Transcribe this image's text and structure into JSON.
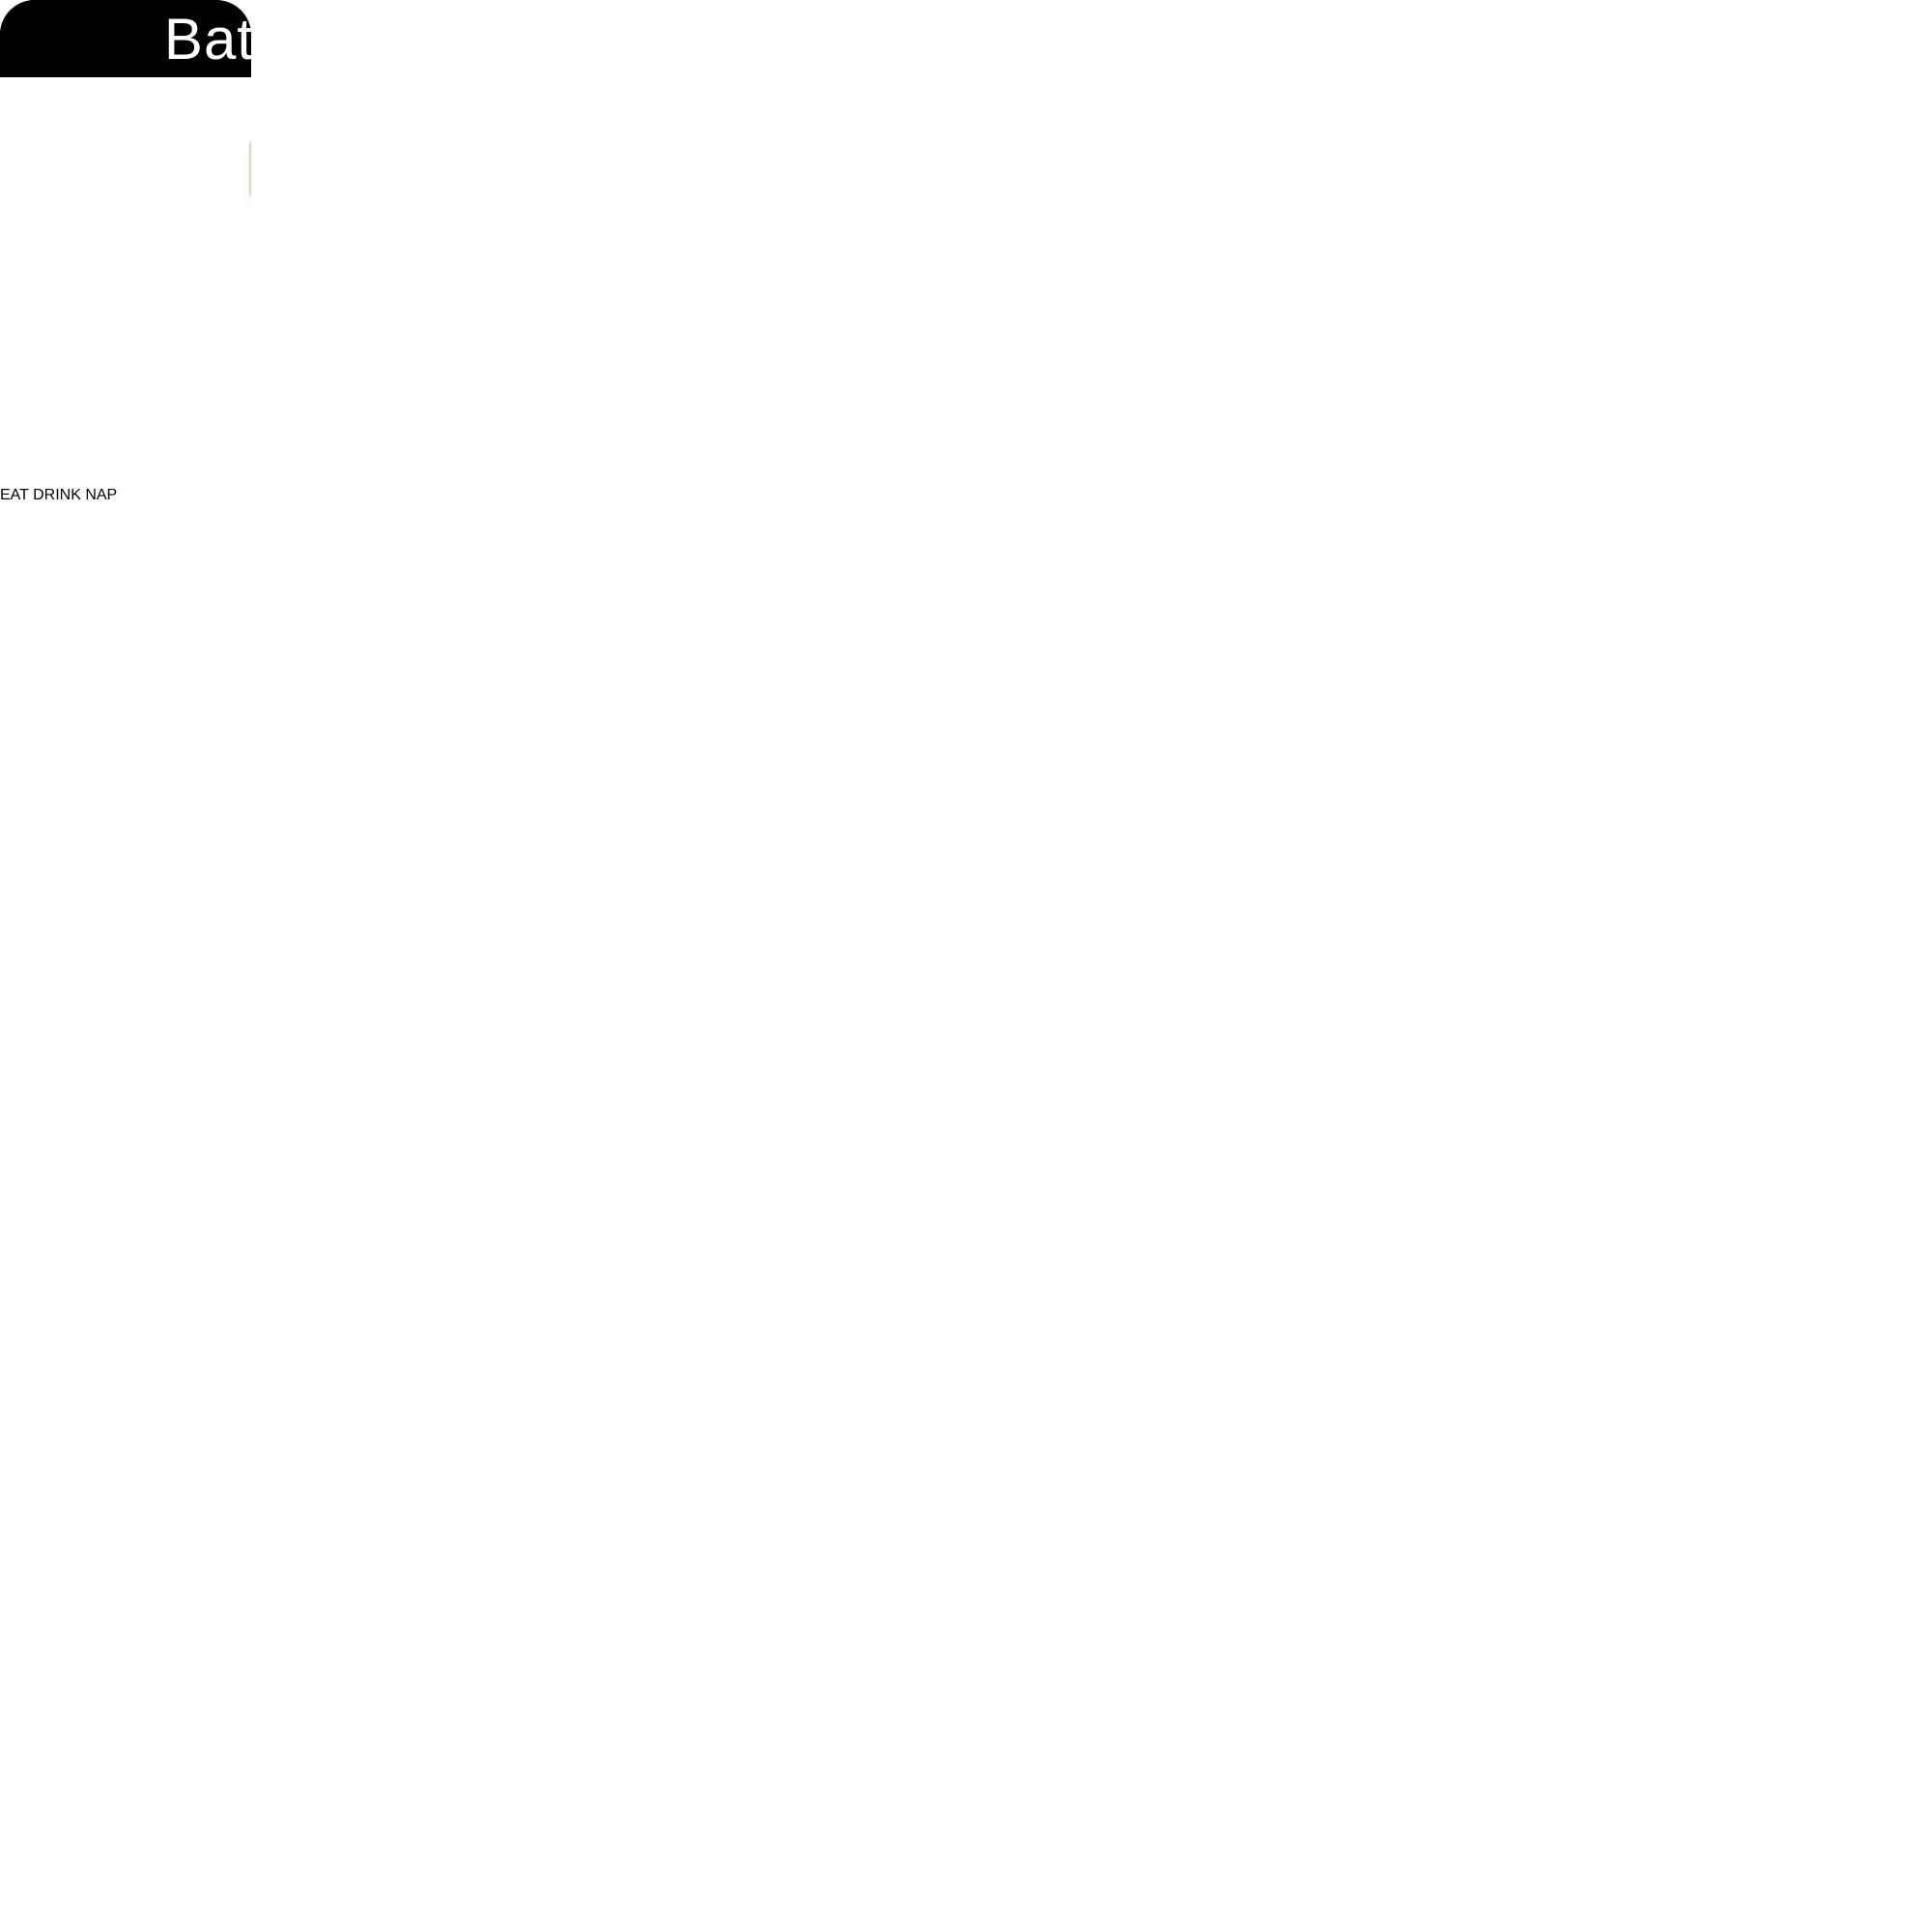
{
  "collage": {
    "description": "three-scene product collage of a 6-light black vanity light fixture with white cylindrical glass shades",
    "sections": [
      {
        "id": "living-room",
        "label": "Living Room"
      },
      {
        "id": "dining-room",
        "label": "Dining Room"
      },
      {
        "id": "bathroom",
        "label": "Bathroom"
      }
    ]
  },
  "fixture": {
    "lights_count": 6,
    "metal_color": "#1b1917",
    "shade_color": "#f7f1e2"
  },
  "inset_decor": {
    "shelf_sign_line1": "EAT",
    "shelf_sign_line2": "DRINK",
    "shelf_sign_line3": "NAP"
  },
  "colors": {
    "label_bg": "#000000",
    "label_text": "#ffffff",
    "living_wall_tan": "#d5c2a4",
    "dining_wall_cream": "#e7dbc2",
    "bathroom_wall_white": "#f0f2f1",
    "art_mat_green": "#47795a",
    "vanity_gray": "#b4b7b8",
    "rattan_tan": "#96764a",
    "mirror_frame": "#26292a"
  }
}
